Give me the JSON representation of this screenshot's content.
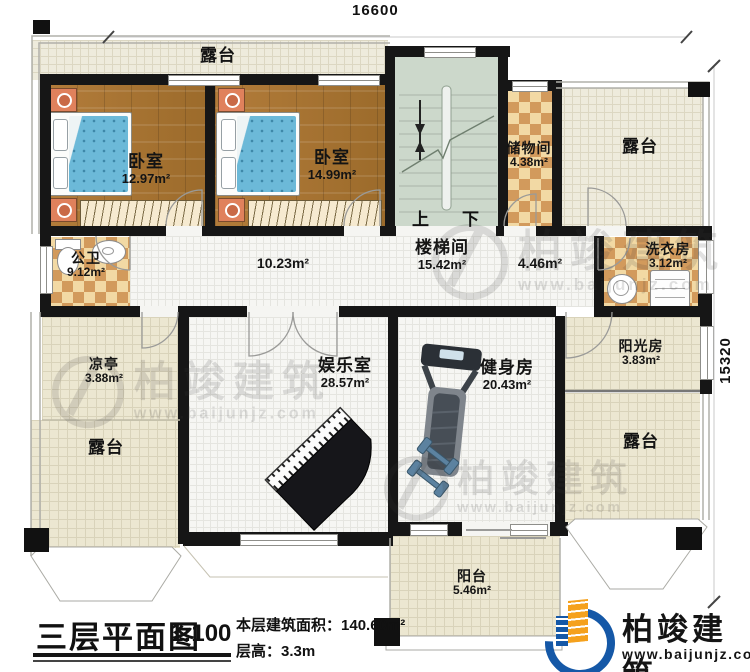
{
  "dimensions": {
    "top": "16600",
    "right": "15320"
  },
  "stairs": {
    "up": "上",
    "down": "下"
  },
  "rooms": {
    "terrace_top": {
      "name": "露台"
    },
    "bedroom_left": {
      "name": "卧室",
      "area": "12.97m²"
    },
    "bedroom_right": {
      "name": "卧室",
      "area": "14.99m²"
    },
    "storage": {
      "name": "储物间",
      "area": "4.38m²"
    },
    "terrace_top_right": {
      "name": "露台"
    },
    "bath": {
      "name": "公卫",
      "area": "9.12m²"
    },
    "corridor": {
      "area": "10.23m²"
    },
    "stairwell": {
      "name": "楼梯间",
      "area": "15.42m²"
    },
    "passage": {
      "area": "4.46m²"
    },
    "laundry": {
      "name": "洗衣房",
      "area": "3.12m²"
    },
    "pavilion": {
      "name": "凉亭",
      "area": "3.88m²"
    },
    "terrace_left": {
      "name": "露台"
    },
    "entertainment": {
      "name": "娱乐室",
      "area": "28.57m²"
    },
    "gym": {
      "name": "健身房",
      "area": "20.43m²"
    },
    "sunroom": {
      "name": "阳光房",
      "area": "3.83m²"
    },
    "terrace_right": {
      "name": "露台"
    },
    "balcony": {
      "name": "阳台",
      "area": "5.46m²"
    }
  },
  "titleblock": {
    "title": "三层平面图",
    "scale": "1:100",
    "area_label": "本层建筑面积：",
    "area_value": "140.60m²",
    "height_label": "层高：",
    "height_value": "3.3m"
  },
  "watermark": {
    "brand": "柏竣建筑",
    "url": "www.baijunjz.com"
  },
  "logo": {
    "brand": "柏竣建筑",
    "url": "www.baijunjz.com"
  },
  "colors": {
    "wall": "#161616",
    "wood": "#aa7431",
    "tile_checker": "#d29a5c",
    "terrace": "#eeebdc",
    "stair": "#ccd8cb",
    "bed": "#6cb9d8",
    "logo_blue": "#1558a7",
    "logo_orange": "#f5a11d"
  }
}
